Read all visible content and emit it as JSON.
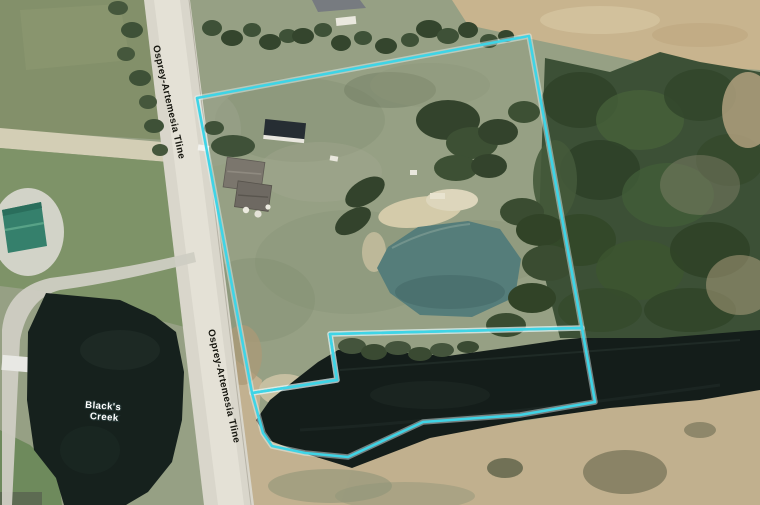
{
  "map": {
    "type": "aerial-imagery-with-parcel-outline",
    "road_labels": [
      "Osprey-Artemesia Tline",
      "Osprey-Artemesia Tline"
    ],
    "creek_label": {
      "full": "Black's Creek",
      "line1": "Black's",
      "line2": "Creek"
    },
    "boundary_color": "#3fd4e6",
    "boundary_halo_color": "#e6fbfd",
    "feature_colors": {
      "road": "#d9d6cb",
      "grass_field": "#96a084",
      "forest": "#3c5036",
      "creek_water": "#141d1a",
      "pond_dark": "#16211d",
      "pond_teal": "#557d7a",
      "dry_field": "#c8b48e",
      "green_roof": "#35806c"
    }
  }
}
